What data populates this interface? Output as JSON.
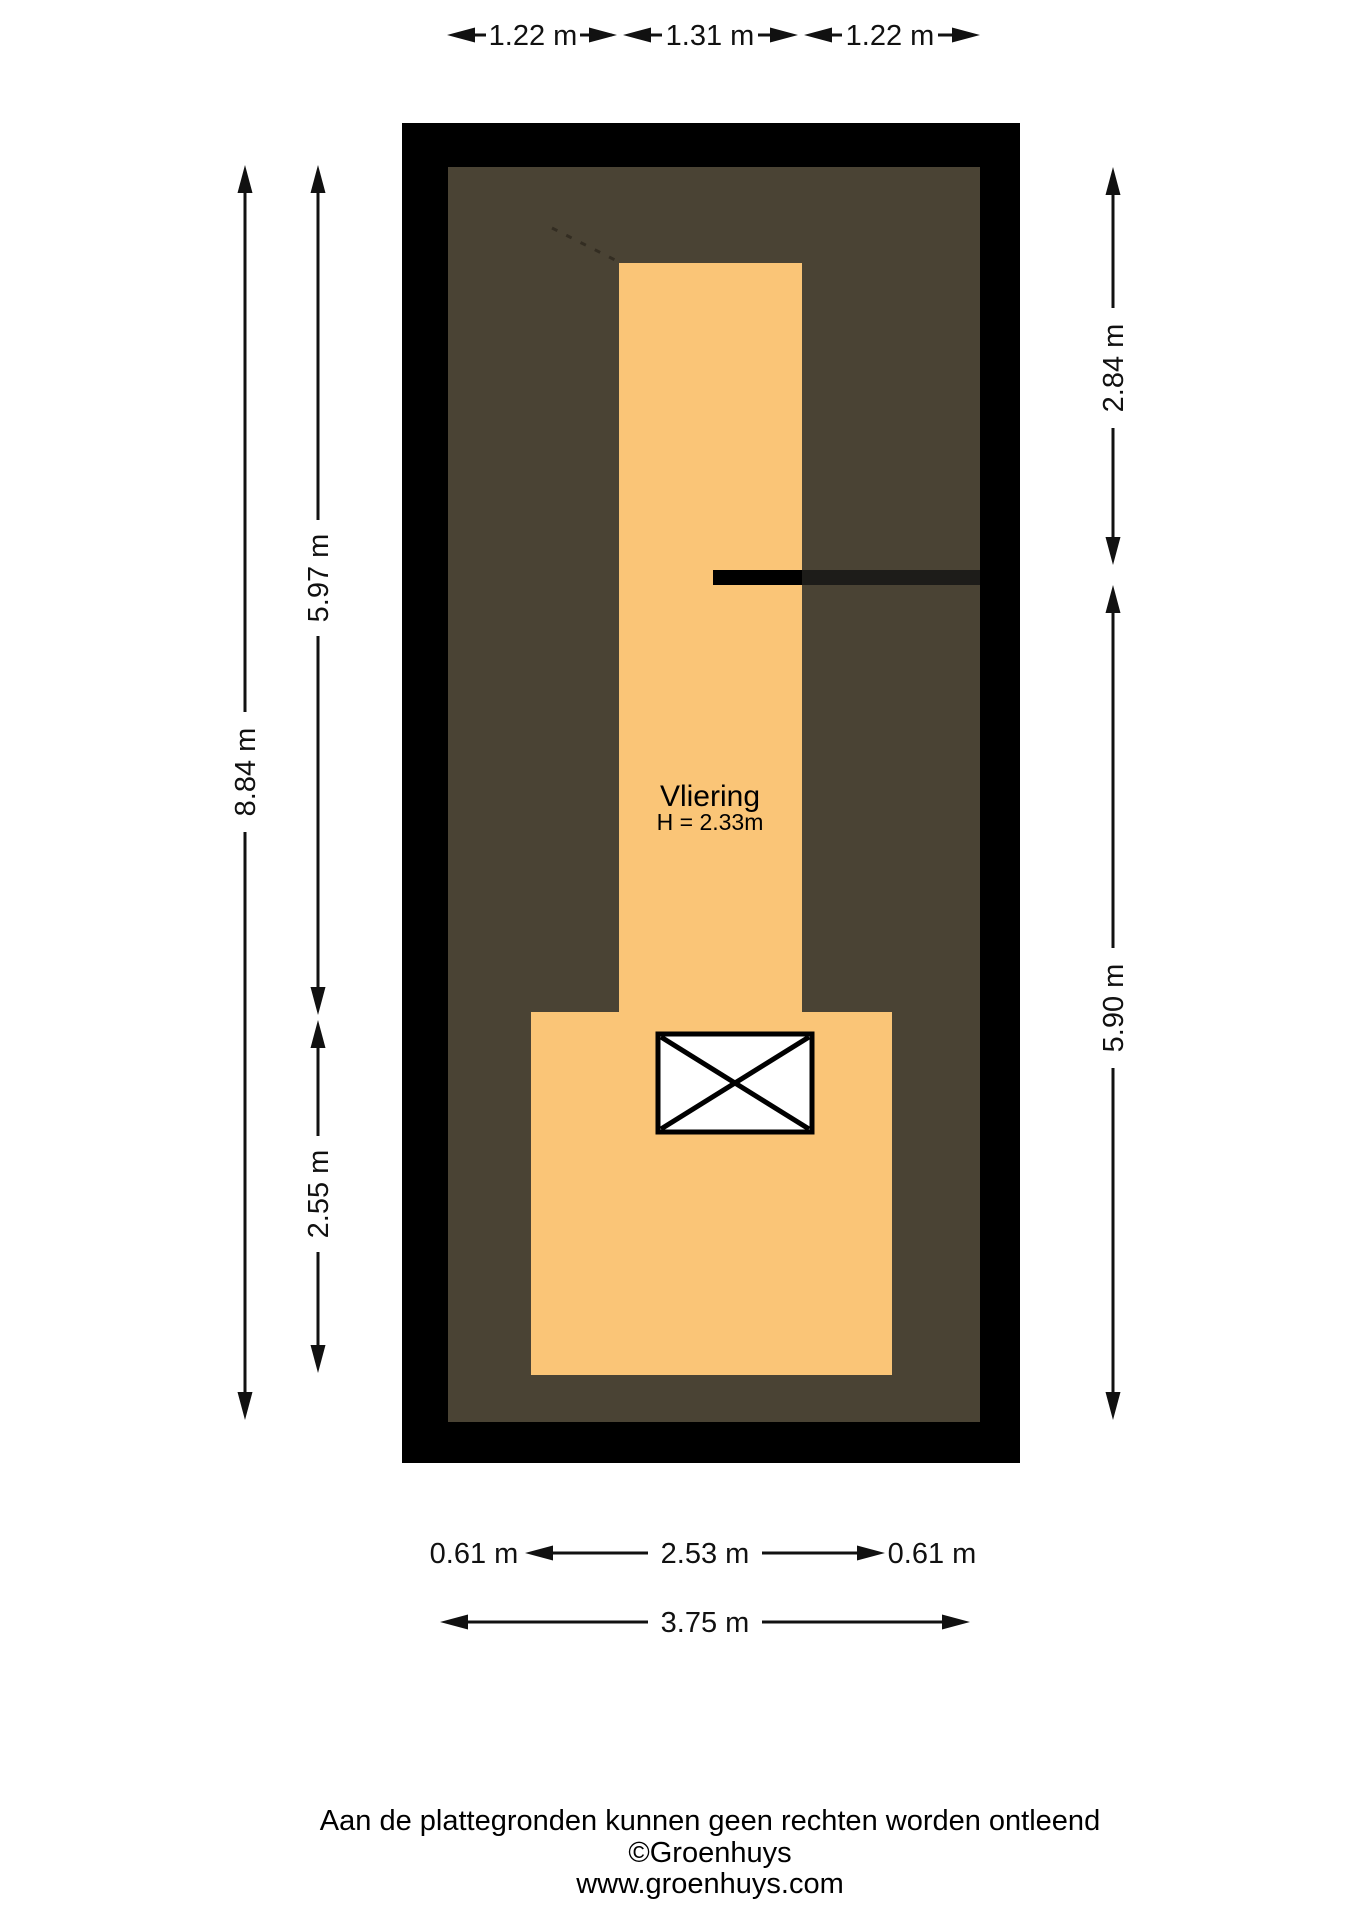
{
  "plan": {
    "room": {
      "name": "Vliering",
      "height_label": "H = 2.33m"
    },
    "colors": {
      "roof_area": "#4A4334",
      "floor_area": "#FAC577",
      "outer_wall": "#000000",
      "inner_wall_line": "#1D1C19",
      "stairs_fill": "#FFFFFF"
    }
  },
  "dimensions": {
    "top": [
      "1.22 m",
      "1.31 m",
      "1.22 m"
    ],
    "left_total": "8.84 m",
    "left_upper": "5.97 m",
    "left_lower": "2.55 m",
    "right_upper": "2.84 m",
    "right_lower": "5.90 m",
    "bottom_left": "0.61 m",
    "bottom_middle": "2.53 m",
    "bottom_right": "0.61 m",
    "bottom_total": "3.75 m"
  },
  "footer": {
    "disclaimer": "Aan de plattegronden kunnen geen rechten worden ontleend",
    "copyright": "©Groenhuys",
    "website": "www.groenhuys.com"
  }
}
